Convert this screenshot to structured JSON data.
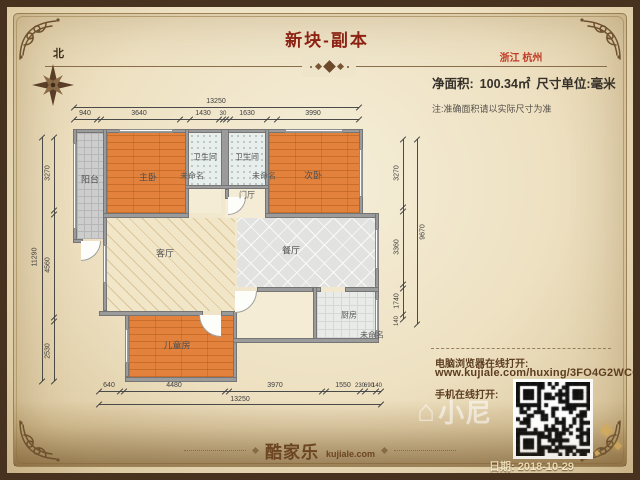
{
  "header": {
    "title": "新块-副本",
    "location": "浙江 杭州",
    "area_label": "净面积:",
    "area_value": "100.34㎡",
    "unit_label": "尺寸单位:毫米",
    "note": "注:准确面积请以实际尺寸为准"
  },
  "compass": {
    "north_label": "北"
  },
  "plan": {
    "rooms": [
      {
        "name": "balcony",
        "label": "阳台"
      },
      {
        "name": "master-bedroom",
        "label": "主卧"
      },
      {
        "name": "unnamed-1",
        "label": "未命名"
      },
      {
        "name": "bathroom-1",
        "label": "卫生间"
      },
      {
        "name": "bathroom-2",
        "label": "卫生间"
      },
      {
        "name": "unnamed-2",
        "label": "未命名"
      },
      {
        "name": "second-bedroom",
        "label": "次卧"
      },
      {
        "name": "entry-hall",
        "label": "门厅"
      },
      {
        "name": "living-room",
        "label": "客厅"
      },
      {
        "name": "dining-room",
        "label": "餐厅"
      },
      {
        "name": "kitchen",
        "label": "厨房"
      },
      {
        "name": "unnamed-3",
        "label": "未命名"
      },
      {
        "name": "kids-room",
        "label": "儿童房"
      }
    ],
    "dims": {
      "top_total": "13250",
      "top_segments": [
        "940",
        "3640",
        "1430",
        "30",
        "1630",
        "3990"
      ],
      "left_total": "11290",
      "left_segments": [
        "3270",
        "4560",
        "2530"
      ],
      "right_total": "9670",
      "right_segments": [
        "3270",
        "3360",
        "1740",
        "140"
      ],
      "bottom_total": "13250",
      "bottom_segments": [
        "640",
        "4480",
        "3970",
        "1550",
        "230",
        "690",
        "140"
      ]
    }
  },
  "footer": {
    "pc_label": "电脑浏览器在线打开:",
    "url": "www.kujiale.com/huxing/3FO4G2WCCO2C",
    "mobile_label": "手机在线打开:",
    "date": "日期: 2018-10-29",
    "logo_zh": "酷家乐",
    "logo_en": "kujiale.com",
    "watermark_icon": "⌂",
    "watermark_text": "小尼"
  },
  "colors": {
    "title_red": "#8e2013",
    "location_red": "#c23a26",
    "frame_brown": "#46321f",
    "wood_floor": "#e2823c",
    "wall_gray": "#9b9b9b",
    "parchment": "#eee1c2"
  }
}
